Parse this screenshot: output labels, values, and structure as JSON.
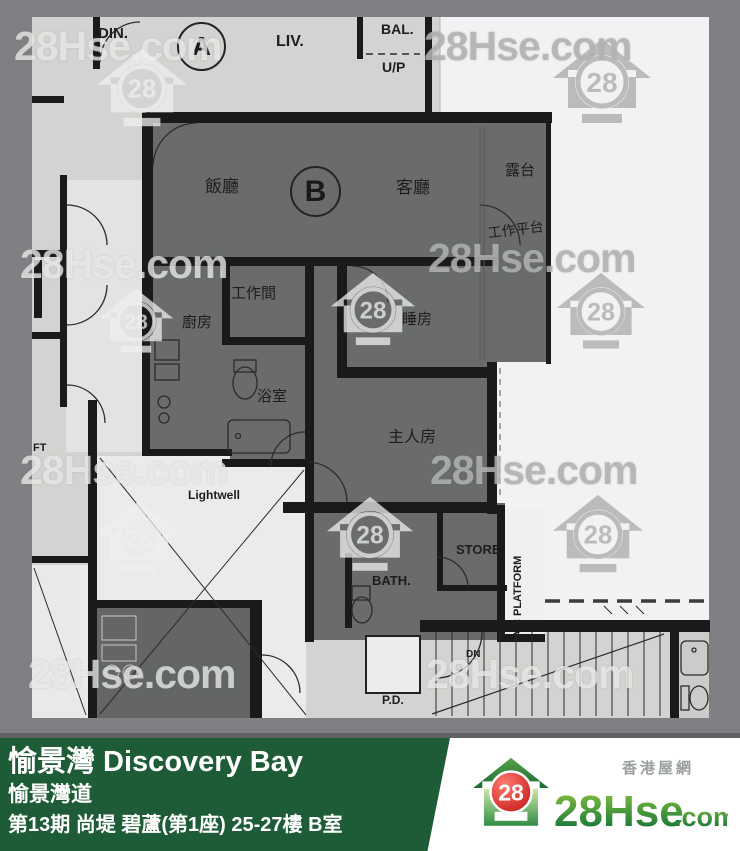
{
  "watermark": {
    "text": "28Hse.com",
    "badge": "28",
    "text_positions": [
      {
        "x": 14,
        "y": 26,
        "tone": "light"
      },
      {
        "x": 424,
        "y": 26,
        "tone": "dim"
      },
      {
        "x": 20,
        "y": 244,
        "tone": "light"
      },
      {
        "x": 428,
        "y": 238,
        "tone": "dim"
      },
      {
        "x": 20,
        "y": 450,
        "tone": "light"
      },
      {
        "x": 430,
        "y": 450,
        "tone": "dim"
      },
      {
        "x": 28,
        "y": 654,
        "tone": "light"
      },
      {
        "x": 426,
        "y": 654,
        "tone": "light"
      }
    ],
    "house_positions": [
      {
        "x": 96,
        "y": 48,
        "s": 92,
        "tone": "light"
      },
      {
        "x": 552,
        "y": 38,
        "s": 100,
        "tone": "dim"
      },
      {
        "x": 98,
        "y": 288,
        "s": 76,
        "tone": "light"
      },
      {
        "x": 330,
        "y": 272,
        "s": 86,
        "tone": "light"
      },
      {
        "x": 556,
        "y": 272,
        "s": 90,
        "tone": "dim"
      },
      {
        "x": 96,
        "y": 500,
        "s": 86,
        "tone": "light"
      },
      {
        "x": 326,
        "y": 496,
        "s": 88,
        "tone": "light"
      },
      {
        "x": 552,
        "y": 494,
        "s": 92,
        "tone": "dim"
      }
    ]
  },
  "plan": {
    "unit_circles": [
      {
        "id": "unit-a",
        "label": "A",
        "x": 177,
        "y": 22,
        "d": 45,
        "fs": 26
      },
      {
        "id": "unit-b",
        "label": "B",
        "x": 290,
        "y": 166,
        "d": 47,
        "fs": 30
      }
    ],
    "labels": [
      {
        "id": "din",
        "text": "DIN.",
        "x": 98,
        "y": 26,
        "fs": 15,
        "bold": true
      },
      {
        "id": "liv",
        "text": "LIV.",
        "x": 276,
        "y": 34,
        "fs": 16,
        "bold": true
      },
      {
        "id": "bal",
        "text": "BAL.",
        "x": 381,
        "y": 22,
        "fs": 14,
        "bold": true
      },
      {
        "id": "up",
        "text": "U/P",
        "x": 382,
        "y": 60,
        "fs": 14,
        "bold": true
      },
      {
        "id": "dining",
        "text": "飯廳",
        "x": 205,
        "y": 178,
        "fs": 17
      },
      {
        "id": "living",
        "text": "客廳",
        "x": 396,
        "y": 179,
        "fs": 17
      },
      {
        "id": "balcony",
        "text": "露台",
        "x": 505,
        "y": 163,
        "fs": 15
      },
      {
        "id": "platform",
        "text": "工作平台",
        "x": 487,
        "y": 226,
        "fs": 14,
        "rot": -7
      },
      {
        "id": "workroom",
        "text": "工作間",
        "x": 231,
        "y": 286,
        "fs": 15
      },
      {
        "id": "kitchen",
        "text": "廚房",
        "x": 182,
        "y": 315,
        "fs": 15
      },
      {
        "id": "bedroom",
        "text": "睡房",
        "x": 402,
        "y": 312,
        "fs": 15
      },
      {
        "id": "bathroom",
        "text": "浴室",
        "x": 257,
        "y": 389,
        "fs": 15
      },
      {
        "id": "master",
        "text": "主人房",
        "x": 388,
        "y": 430,
        "fs": 16
      },
      {
        "id": "lightwell",
        "text": "Lightwell",
        "x": 188,
        "y": 489,
        "fs": 12,
        "bold": true
      },
      {
        "id": "store",
        "text": "STORE",
        "x": 456,
        "y": 543,
        "fs": 13,
        "bold": true
      },
      {
        "id": "bath2",
        "text": "BATH.",
        "x": 372,
        "y": 574,
        "fs": 13,
        "bold": true
      },
      {
        "id": "acplatform",
        "text": "A/C PLATFORM",
        "x": 513,
        "y": 638,
        "fs": 11,
        "rot": -90,
        "bold": true
      },
      {
        "id": "dn",
        "text": "DN",
        "x": 466,
        "y": 650,
        "fs": 10,
        "bold": true
      },
      {
        "id": "pd",
        "text": "P.D.",
        "x": 382,
        "y": 694,
        "fs": 12,
        "bold": true
      },
      {
        "id": "lift",
        "text": "FT",
        "x": 33,
        "y": 443,
        "fs": 11,
        "bold": true
      }
    ]
  },
  "footer": {
    "estate": "愉景灣 Discovery Bay",
    "street": "愉景灣道",
    "detail": "第13期 尚堤 碧蘆(第1座) 25-27樓 B室",
    "bg_color": "#1e5c38"
  },
  "logo": {
    "badge": "28",
    "name": "28Hse",
    "tld": ".com",
    "tagline": "香港屋網",
    "green_dark": "#056a38",
    "green_light": "#8dc63f",
    "red": "#d01e1e"
  }
}
